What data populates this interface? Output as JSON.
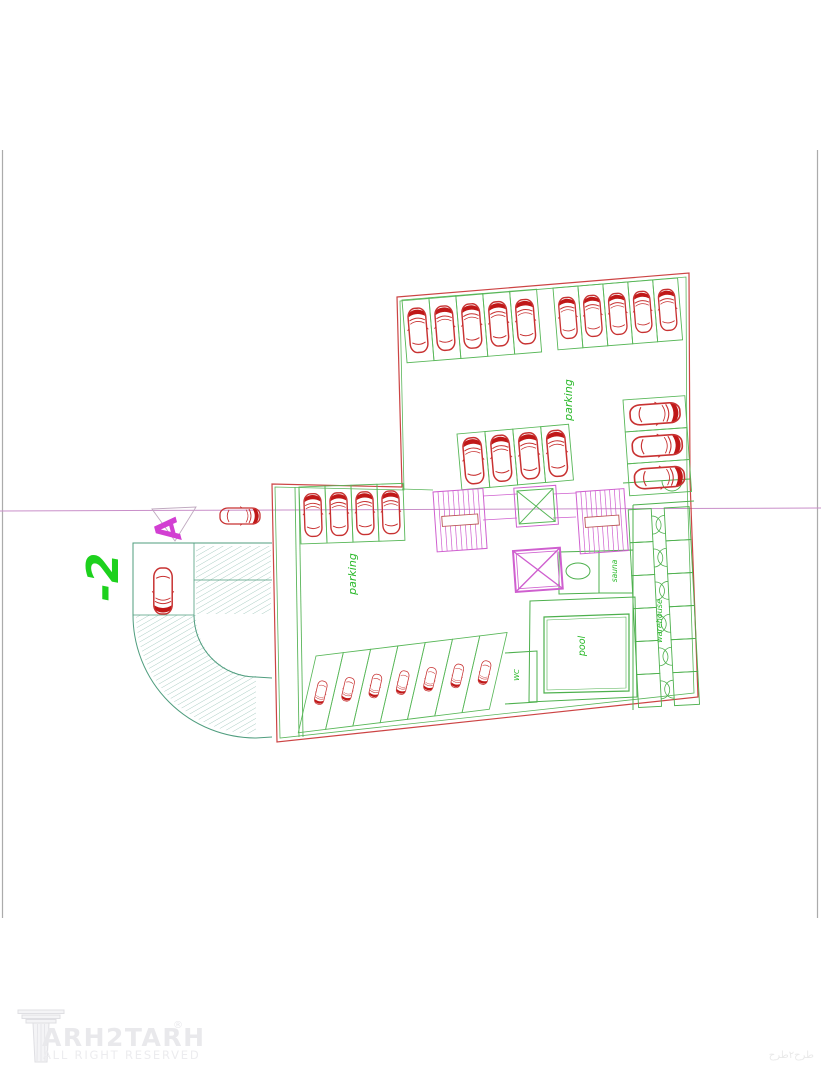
{
  "labels": {
    "parking_upper": "parking",
    "parking_lower": "parking",
    "pool": "pool",
    "sauna": "sauna",
    "warehouse": "warehouse",
    "wc": "WC",
    "level": "-2",
    "section_marker": "A"
  },
  "logo": {
    "brand": "ARH2TARH",
    "registered": "®",
    "tagline": "ALL RIGHT RESERVED"
  },
  "corner_mark": "طرح۲طرح",
  "colors": {
    "wall_red": "#cc4444",
    "car_red": "#c83232",
    "car_red_dark": "#c01818",
    "stall_green": "#58b758",
    "room_green": "#4db04d",
    "label_green": "#28b828",
    "level_green": "#1dd11d",
    "magenta": "#cf5fcf",
    "rail_red": "#bb5555",
    "section_line": "#c98fc9",
    "triangle_gray": "#bfa8bf",
    "ramp_outline": "#4f9d7e",
    "hatch_teal": "#8cbcae",
    "frame_gray": "#ababab",
    "watermark_gray": "#e9e9ec"
  },
  "plan": {
    "car_rows": [
      {
        "name": "upper-hall-top-left",
        "x": 402,
        "y": 300,
        "angle": -4.6,
        "count": 5,
        "stall_w": 27,
        "stall_h": 63,
        "car_rot": 0
      },
      {
        "name": "upper-hall-top-right",
        "x": 553,
        "y": 288,
        "angle": -4.6,
        "count": 5,
        "stall_w": 25,
        "stall_h": 62,
        "car_rot": 0
      },
      {
        "name": "upper-hall-middle",
        "x": 457,
        "y": 434,
        "angle": -5,
        "count": 4,
        "stall_w": 28,
        "stall_h": 56,
        "car_rot": 0
      },
      {
        "name": "lower-hall-top",
        "x": 299,
        "y": 487,
        "angle": -2,
        "count": 4,
        "stall_w": 26,
        "stall_h": 57,
        "car_rot": 0
      },
      {
        "name": "lower-hall-bottom-angled",
        "x": 316,
        "y": 656,
        "angle": -7,
        "count": 7,
        "stall_w": 27.5,
        "stall_h": 74,
        "car_rot": 200,
        "skew": -20
      },
      {
        "name": "right-side-column",
        "x": 623,
        "y": 400,
        "angle": -4,
        "count": 3,
        "stall_w": 62,
        "stall_h": 32,
        "car_rot": 90,
        "dir": "v"
      }
    ],
    "single_cars": [
      {
        "name": "ramp-car",
        "cx": 163,
        "cy": 591,
        "rot": 180,
        "scale": 1.15
      },
      {
        "name": "entry-car",
        "cx": 240,
        "cy": 516,
        "rot": 90,
        "scale": 1.0
      }
    ],
    "stairs": [
      {
        "name": "stair-west",
        "x": 433,
        "y": 492,
        "w": 50,
        "h": 60,
        "angle": -4,
        "steps": 10
      },
      {
        "name": "stair-east",
        "x": 576,
        "y": 492,
        "w": 48,
        "h": 62,
        "angle": -4,
        "steps": 10
      }
    ],
    "elevators": [
      {
        "name": "elevator-upper",
        "x": 517,
        "y": 491,
        "w": 36,
        "h": 33,
        "angle": -4,
        "style": "green"
      },
      {
        "name": "elevator-lower",
        "x": 513,
        "y": 551,
        "w": 47,
        "h": 41,
        "angle": -4,
        "style": "magenta"
      }
    ],
    "warehouse": {
      "angle": -3,
      "pivot": [
        665,
        600
      ],
      "rows": 6,
      "cell_h": 33,
      "y": 508,
      "cols": [
        {
          "x": 633,
          "w": 23,
          "door": "east"
        },
        {
          "x": 669,
          "w": 25,
          "door": "west"
        }
      ]
    }
  }
}
